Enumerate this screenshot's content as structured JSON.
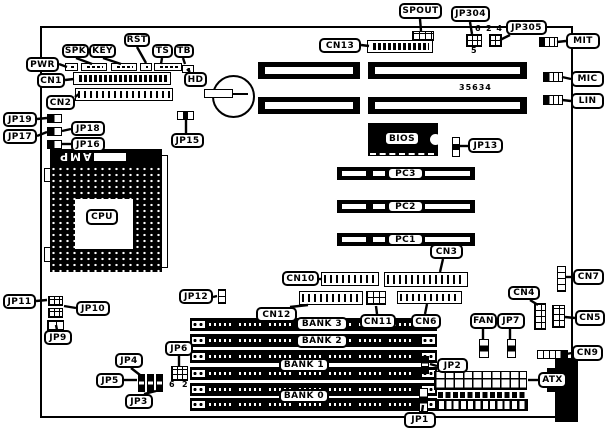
{
  "diagram_title": "motherboard-layout",
  "chip_labels": {
    "amp": "AMP"
  },
  "annotations": [
    {
      "id": "jp304-pin-6",
      "text": "6",
      "x": 475,
      "y": 24
    },
    {
      "id": "jp304-pin-5",
      "text": "5",
      "x": 471,
      "y": 46
    },
    {
      "id": "jp305-pins-2-4",
      "text": "2 4",
      "x": 486,
      "y": 24
    },
    {
      "id": "jp6-pin-6",
      "text": "6",
      "x": 169,
      "y": 380
    },
    {
      "id": "jp6-pin-2",
      "text": "2",
      "x": 182,
      "y": 380
    },
    {
      "id": "board-number",
      "text": "35634",
      "x": 459,
      "y": 83
    }
  ],
  "callouts": [
    {
      "id": "spout",
      "label": "SPOUT",
      "x": 399,
      "y": 3,
      "w": 43,
      "h": 16,
      "tail": [
        420,
        19,
        421,
        31
      ]
    },
    {
      "id": "jp304",
      "label": "JP304",
      "x": 451,
      "y": 6,
      "w": 39,
      "h": 16,
      "tail": [
        470,
        22,
        472,
        34
      ]
    },
    {
      "id": "jp305",
      "label": "JP305",
      "x": 506,
      "y": 20,
      "w": 41,
      "h": 15,
      "tail": [
        510,
        35,
        500,
        40
      ]
    },
    {
      "id": "mit",
      "label": "MIT",
      "x": 566,
      "y": 33,
      "w": 34,
      "h": 16,
      "tail": [
        566,
        41,
        557,
        42
      ]
    },
    {
      "id": "cn13",
      "label": "CN13",
      "x": 319,
      "y": 38,
      "w": 42,
      "h": 15,
      "tail": [
        361,
        45,
        369,
        46
      ]
    },
    {
      "id": "mic",
      "label": "MIC",
      "x": 571,
      "y": 71,
      "w": 33,
      "h": 16,
      "tail": [
        571,
        79,
        562,
        77
      ]
    },
    {
      "id": "lin",
      "label": "LIN",
      "x": 571,
      "y": 93,
      "w": 33,
      "h": 16,
      "tail": [
        571,
        101,
        562,
        100
      ]
    },
    {
      "id": "pwr",
      "label": "PWR",
      "x": 26,
      "y": 57,
      "w": 33,
      "h": 15,
      "tail": [
        59,
        64,
        67,
        67
      ]
    },
    {
      "id": "spk",
      "label": "SPK",
      "x": 62,
      "y": 44,
      "w": 27,
      "h": 14,
      "tail": [
        76,
        58,
        92,
        64
      ]
    },
    {
      "id": "key",
      "label": "KEY",
      "x": 89,
      "y": 44,
      "w": 27,
      "h": 14,
      "tail": [
        103,
        58,
        121,
        64
      ]
    },
    {
      "id": "rst",
      "label": "RST",
      "x": 124,
      "y": 33,
      "w": 26,
      "h": 14,
      "tail": [
        137,
        47,
        146,
        63
      ]
    },
    {
      "id": "ts",
      "label": "TS",
      "x": 152,
      "y": 44,
      "w": 21,
      "h": 14,
      "tail": [
        162,
        58,
        161,
        64
      ]
    },
    {
      "id": "tb",
      "label": "TB",
      "x": 174,
      "y": 44,
      "w": 20,
      "h": 14,
      "tail": [
        183,
        58,
        185,
        64
      ]
    },
    {
      "id": "hd",
      "label": "HD",
      "x": 184,
      "y": 72,
      "w": 23,
      "h": 15,
      "tail": [
        190,
        72,
        187,
        69
      ]
    },
    {
      "id": "cn1",
      "label": "CN1",
      "x": 37,
      "y": 73,
      "w": 28,
      "h": 15,
      "tail": [
        65,
        80,
        74,
        79
      ]
    },
    {
      "id": "cn2",
      "label": "CN2",
      "x": 46,
      "y": 95,
      "w": 29,
      "h": 15,
      "tail": [
        75,
        97,
        79,
        94
      ]
    },
    {
      "id": "jp19",
      "label": "JP19",
      "x": 3,
      "y": 112,
      "w": 34,
      "h": 15,
      "tail": [
        37,
        119,
        47,
        118
      ]
    },
    {
      "id": "jp18",
      "label": "JP18",
      "x": 71,
      "y": 121,
      "w": 34,
      "h": 15,
      "tail": [
        71,
        129,
        62,
        131
      ]
    },
    {
      "id": "jp17",
      "label": "JP17",
      "x": 3,
      "y": 129,
      "w": 34,
      "h": 15,
      "tail": [
        37,
        136,
        47,
        132
      ]
    },
    {
      "id": "jp16",
      "label": "JP16",
      "x": 71,
      "y": 137,
      "w": 34,
      "h": 15,
      "tail": [
        71,
        144,
        62,
        144
      ]
    },
    {
      "id": "jp15",
      "label": "JP15",
      "x": 171,
      "y": 133,
      "w": 33,
      "h": 15,
      "tail": [
        186,
        133,
        186,
        120
      ]
    },
    {
      "id": "jp13",
      "label": "JP13",
      "x": 468,
      "y": 138,
      "w": 35,
      "h": 15,
      "tail": [
        468,
        146,
        460,
        146
      ]
    },
    {
      "id": "bios",
      "label": "BIOS",
      "x": 384,
      "y": 131,
      "w": 36,
      "h": 15,
      "tail": null
    },
    {
      "id": "pc3",
      "label": "PC3",
      "x": 387,
      "y": 167,
      "w": 37,
      "h": 13,
      "tail": null
    },
    {
      "id": "pc2",
      "label": "PC2",
      "x": 387,
      "y": 200,
      "w": 37,
      "h": 13,
      "tail": null
    },
    {
      "id": "pc1",
      "label": "PC1",
      "x": 387,
      "y": 233,
      "w": 37,
      "h": 13,
      "tail": null
    },
    {
      "id": "cn3",
      "label": "CN3",
      "x": 430,
      "y": 244,
      "w": 33,
      "h": 15,
      "tail": [
        443,
        259,
        440,
        272
      ]
    },
    {
      "id": "cpu",
      "label": "CPU",
      "x": 86,
      "y": 209,
      "w": 32,
      "h": 16,
      "tail": null
    },
    {
      "id": "cn10",
      "label": "CN10",
      "x": 282,
      "y": 271,
      "w": 37,
      "h": 15,
      "tail": [
        319,
        279,
        322,
        279
      ]
    },
    {
      "id": "jp12",
      "label": "JP12",
      "x": 179,
      "y": 289,
      "w": 34,
      "h": 15,
      "tail": [
        213,
        297,
        217,
        296
      ]
    },
    {
      "id": "cn12",
      "label": "CN12",
      "x": 256,
      "y": 307,
      "w": 41,
      "h": 15,
      "tail": [
        290,
        307,
        308,
        305
      ]
    },
    {
      "id": "cn11",
      "label": "CN11",
      "x": 360,
      "y": 314,
      "w": 36,
      "h": 15,
      "tail": [
        377,
        314,
        376,
        306
      ]
    },
    {
      "id": "cn6",
      "label": "CN6",
      "x": 411,
      "y": 314,
      "w": 30,
      "h": 15,
      "tail": [
        425,
        314,
        427,
        304
      ]
    },
    {
      "id": "cn7",
      "label": "CN7",
      "x": 573,
      "y": 269,
      "w": 31,
      "h": 16,
      "tail": [
        573,
        277,
        566,
        277
      ]
    },
    {
      "id": "cn4",
      "label": "CN4",
      "x": 508,
      "y": 286,
      "w": 32,
      "h": 14,
      "tail": [
        530,
        300,
        538,
        305
      ]
    },
    {
      "id": "cn5",
      "label": "CN5",
      "x": 575,
      "y": 310,
      "w": 30,
      "h": 16,
      "tail": [
        575,
        318,
        565,
        317
      ]
    },
    {
      "id": "fan",
      "label": "FAN",
      "x": 470,
      "y": 313,
      "w": 27,
      "h": 16,
      "tail": [
        483,
        329,
        483,
        339
      ]
    },
    {
      "id": "jp7",
      "label": "JP7",
      "x": 497,
      "y": 313,
      "w": 28,
      "h": 16,
      "tail": [
        510,
        329,
        510,
        339
      ]
    },
    {
      "id": "cn9",
      "label": "CN9",
      "x": 572,
      "y": 345,
      "w": 31,
      "h": 16,
      "tail": [
        572,
        353,
        566,
        354
      ]
    },
    {
      "id": "jp2",
      "label": "JP2",
      "x": 437,
      "y": 358,
      "w": 31,
      "h": 15,
      "tail": [
        437,
        366,
        430,
        364
      ]
    },
    {
      "id": "atx",
      "label": "ATX",
      "x": 538,
      "y": 372,
      "w": 29,
      "h": 16,
      "tail": [
        538,
        380,
        528,
        380
      ]
    },
    {
      "id": "jp1",
      "label": "JP1",
      "x": 404,
      "y": 412,
      "w": 32,
      "h": 16,
      "tail": [
        422,
        412,
        423,
        405
      ]
    },
    {
      "id": "jp11",
      "label": "JP11",
      "x": 3,
      "y": 294,
      "w": 33,
      "h": 15,
      "tail": [
        36,
        301,
        47,
        300
      ]
    },
    {
      "id": "jp10",
      "label": "JP10",
      "x": 76,
      "y": 301,
      "w": 34,
      "h": 15,
      "tail": [
        76,
        308,
        64,
        306
      ]
    },
    {
      "id": "jp9",
      "label": "JP9",
      "x": 44,
      "y": 330,
      "w": 28,
      "h": 15,
      "tail": [
        57,
        330,
        56,
        325
      ]
    },
    {
      "id": "jp4",
      "label": "JP4",
      "x": 115,
      "y": 353,
      "w": 28,
      "h": 15,
      "tail": [
        131,
        368,
        140,
        375
      ]
    },
    {
      "id": "jp5",
      "label": "JP5",
      "x": 96,
      "y": 373,
      "w": 28,
      "h": 15,
      "tail": [
        124,
        380,
        137,
        380
      ]
    },
    {
      "id": "jp3",
      "label": "JP3",
      "x": 125,
      "y": 394,
      "w": 28,
      "h": 15,
      "tail": [
        144,
        394,
        156,
        391
      ]
    },
    {
      "id": "jp6",
      "label": "JP6",
      "x": 165,
      "y": 341,
      "w": 28,
      "h": 15,
      "tail": [
        179,
        356,
        179,
        366
      ]
    },
    {
      "id": "bank3",
      "label": "BANK 3",
      "x": 296,
      "y": 317,
      "w": 52,
      "h": 14,
      "tail": null
    },
    {
      "id": "bank2",
      "label": "BANK 2",
      "x": 296,
      "y": 334,
      "w": 52,
      "h": 14,
      "tail": null
    },
    {
      "id": "bank1",
      "label": "BANK 1",
      "x": 279,
      "y": 358,
      "w": 50,
      "h": 14,
      "tail": null
    },
    {
      "id": "bank0",
      "label": "BANK 0",
      "x": 279,
      "y": 389,
      "w": 50,
      "h": 14,
      "tail": null
    }
  ]
}
